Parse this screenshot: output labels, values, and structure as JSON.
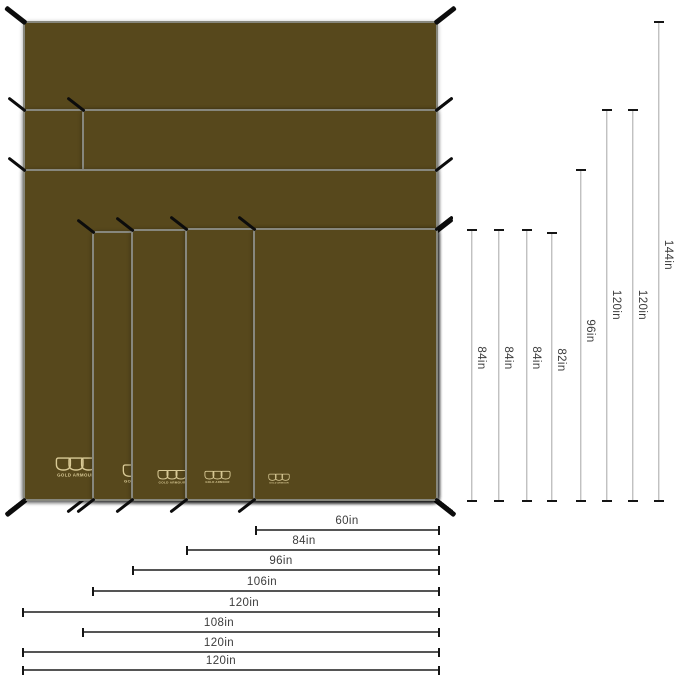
{
  "brand": {
    "name": "GOLD ARMOUR"
  },
  "diagram": {
    "description": "Flat camping tarp size comparison: eight olive tarps stacked aligned to a shared bottom-right corner, with black corner tie-outs and dimension lines showing widths and heights in inches",
    "unit": "in",
    "sizes": [
      "60in x 84in",
      "84in x 84in",
      "96in x 84in",
      "106in x 82in",
      "120in x 96in",
      "108in x 120in",
      "120in x 120in",
      "120in x 144in"
    ]
  },
  "height_dims": [
    {
      "label": "84in"
    },
    {
      "label": "84in"
    },
    {
      "label": "84in"
    },
    {
      "label": "82in"
    },
    {
      "label": "96in"
    },
    {
      "label": "120in"
    },
    {
      "label": "120in"
    },
    {
      "label": "144in"
    }
  ],
  "width_dims": [
    {
      "label": "60in"
    },
    {
      "label": "84in"
    },
    {
      "label": "96in"
    },
    {
      "label": "106in"
    },
    {
      "label": "120in"
    },
    {
      "label": "108in"
    },
    {
      "label": "120in"
    },
    {
      "label": "120in"
    }
  ],
  "colors": {
    "tarp_fill": "#57481c",
    "tarp_border": "#87877d",
    "tie": "#0c0c0c",
    "logo": "#d9ca96",
    "dim_line_vertical": "#a6a6a6",
    "dim_line_horizontal": "#555555",
    "tick": "#151515",
    "label_text": "#3c3c3c",
    "background": "#ffffff"
  }
}
